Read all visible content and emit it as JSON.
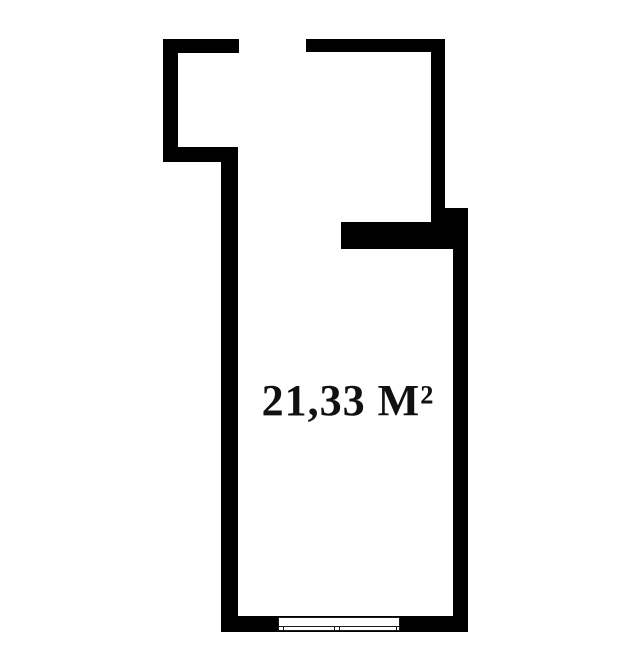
{
  "floorplan": {
    "area_label": "21,33 М²",
    "colors": {
      "wall": "#000000",
      "background": "#ffffff",
      "text": "#111111",
      "window_line": "#1a1a1a"
    },
    "canvas": {
      "width": 623,
      "height": 670
    },
    "walls": [
      {
        "name": "vestibule-top-wall",
        "x": 163,
        "y": 39,
        "w": 76,
        "h": 14
      },
      {
        "name": "vestibule-left-wall",
        "x": 163,
        "y": 39,
        "w": 15,
        "h": 123
      },
      {
        "name": "vestibule-bottom-wall",
        "x": 163,
        "y": 147,
        "w": 75,
        "h": 15
      },
      {
        "name": "left-main-wall",
        "x": 221,
        "y": 147,
        "w": 17,
        "h": 485
      },
      {
        "name": "top-right-wall",
        "x": 306,
        "y": 39,
        "w": 139,
        "h": 13
      },
      {
        "name": "right-upper-wall",
        "x": 431,
        "y": 39,
        "w": 14,
        "h": 183
      },
      {
        "name": "right-step-block",
        "x": 445,
        "y": 208,
        "w": 23,
        "h": 14
      },
      {
        "name": "notch-wall",
        "x": 341,
        "y": 222,
        "w": 127,
        "h": 27
      },
      {
        "name": "right-lower-wall",
        "x": 453,
        "y": 222,
        "w": 15,
        "h": 410
      },
      {
        "name": "bottom-wall",
        "x": 221,
        "y": 616,
        "w": 247,
        "h": 16
      }
    ],
    "window": {
      "x": 278,
      "y": 617,
      "w": 122,
      "h": 14,
      "sill_offset_from_bottom": 3,
      "ticks": [
        4,
        55,
        60,
        117
      ]
    }
  }
}
